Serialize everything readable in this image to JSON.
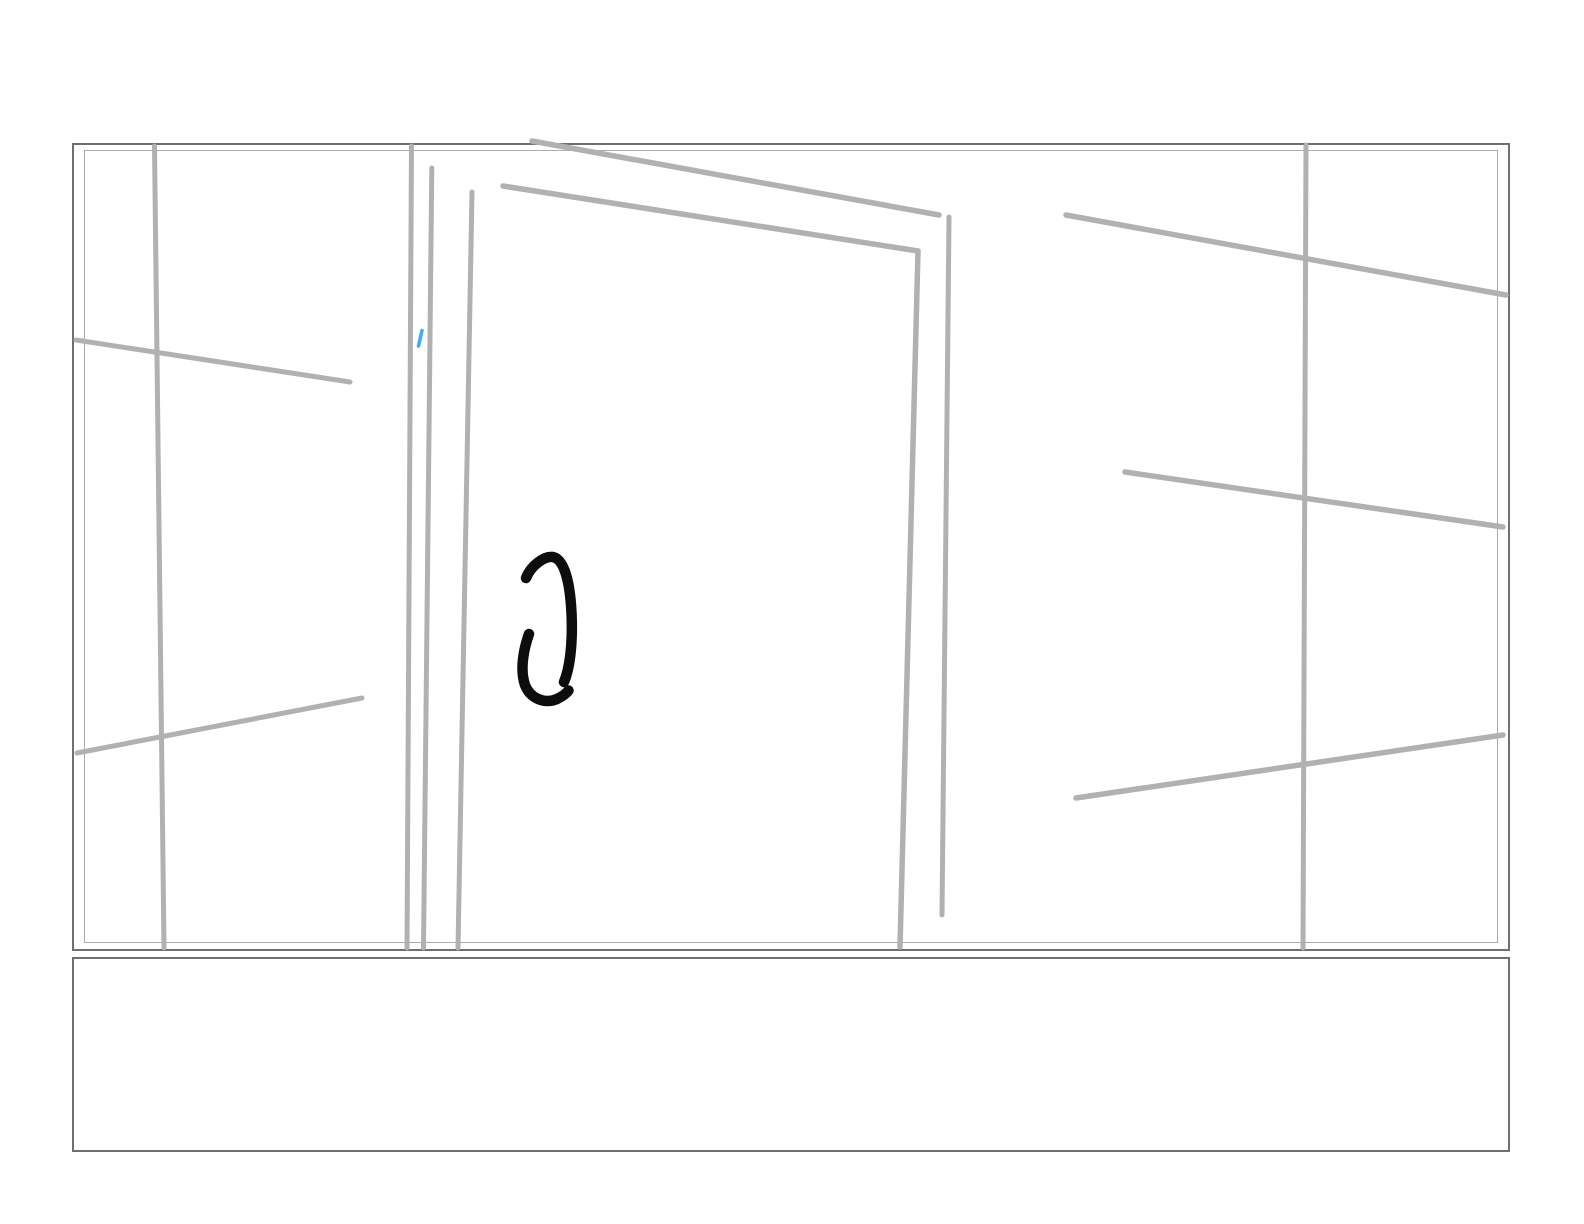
{
  "colors": {
    "background": "#ffffff",
    "frame_border_dark": "#6f6f6f",
    "frame_border_light": "#ababab",
    "pencil_gray": "#b1b1b1",
    "ink_black": "#0d0d0d",
    "accent_blue": "#3fa9f5"
  },
  "canvas": {
    "description": "freehand sketch of a wall with an open door frame",
    "main_area": {
      "x": 72,
      "y": 143,
      "width": 1438,
      "height": 808
    },
    "bottom_area": {
      "x": 72,
      "y": 957,
      "width": 1438,
      "height": 195
    }
  },
  "strokes": [
    {
      "name": "wall-left-vertical-stroke",
      "color": "pencil_gray",
      "width": 5,
      "path": "M154.5,146 L164,948"
    },
    {
      "name": "wall-left-upper-cross-stroke",
      "color": "pencil_gray",
      "width": 5,
      "path": "M76,340 L350,382"
    },
    {
      "name": "wall-left-lower-cross-stroke",
      "color": "pencil_gray",
      "width": 5,
      "path": "M77,753 L362,698"
    },
    {
      "name": "doorframe-left-outer-stroke",
      "color": "pencil_gray",
      "width": 5,
      "path": "M411.5,146 L407,948"
    },
    {
      "name": "doorframe-left-mid-stroke",
      "color": "pencil_gray",
      "width": 5,
      "path": "M431.8,168 L423.5,948"
    },
    {
      "name": "doorframe-left-inner-stroke",
      "color": "pencil_gray",
      "width": 5,
      "path": "M472,192 L458,948"
    },
    {
      "name": "door-top-outer-stroke",
      "color": "pencil_gray",
      "width": 5.5,
      "path": "M532,141 L939,215"
    },
    {
      "name": "door-inner-frame-stroke",
      "color": "pencil_gray",
      "width": 5.5,
      "path": "M503,186 L918,251 L900,947"
    },
    {
      "name": "door-right-outer-stroke",
      "color": "pencil_gray",
      "width": 5,
      "path": "M949,217 L942,915"
    },
    {
      "name": "wall-right-vertical-stroke",
      "color": "pencil_gray",
      "width": 5,
      "path": "M1306,145 L1303,948"
    },
    {
      "name": "wall-right-upper-cross-stroke",
      "color": "pencil_gray",
      "width": 5.5,
      "path": "M1066,215 L1506,295"
    },
    {
      "name": "wall-right-middle-cross-stroke",
      "color": "pencil_gray",
      "width": 5.5,
      "path": "M1125,472 L1503,527"
    },
    {
      "name": "wall-right-lower-cross-stroke",
      "color": "pencil_gray",
      "width": 5.5,
      "path": "M1076,798 L1503,735"
    },
    {
      "name": "blue-tick-stroke",
      "color": "accent_blue",
      "width": 3.5,
      "path": "M422,330.5 L418.5,346"
    },
    {
      "name": "ink-arc-right-stroke",
      "color": "ink_black",
      "width": 10.5,
      "path": "M526,578 C531,565.5 544,556 553,557 C564.5,559.5 570,582 571.5,613 C573,645 569.5,669 564,682"
    },
    {
      "name": "ink-arc-left-stroke",
      "color": "ink_black",
      "width": 10.5,
      "path": "M529,634 C524,648 519.5,669 525,685 C530,698 544,704.5 557,699 C562,696.5 566.5,693.5 568.5,690.5"
    }
  ]
}
